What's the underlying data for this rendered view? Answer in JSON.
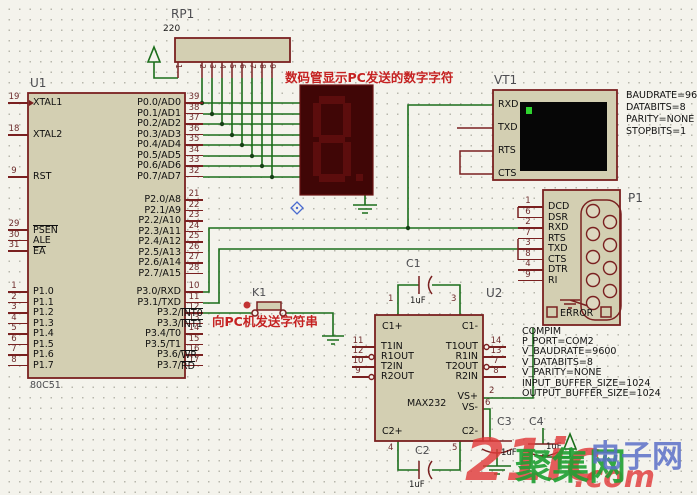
{
  "annotations": {
    "display_note": "数码管显示PC发送的数字字符",
    "send_note": "向PC机发送字符串"
  },
  "watermark": {
    "big": "21ic",
    "dot_com": ".com",
    "green": "聚集网",
    "blue": "电子网"
  },
  "u1": {
    "ref": "U1",
    "part": "80C51",
    "g_xtal1": [
      {
        "n": "19",
        "t": "XTAL1"
      }
    ],
    "g_xtal2": [
      {
        "n": "18",
        "t": "XTAL2"
      }
    ],
    "g_rst": [
      {
        "n": "9",
        "t": "RST"
      }
    ],
    "g_ctrl": [
      {
        "n": "29",
        "t": "",
        "o": "PSEN"
      },
      {
        "n": "30",
        "t": "ALE"
      },
      {
        "n": "31",
        "t": "",
        "o": "EA"
      }
    ],
    "g_p1": [
      {
        "n": "1",
        "t": "P1.0"
      },
      {
        "n": "2",
        "t": "P1.1"
      },
      {
        "n": "3",
        "t": "P1.2"
      },
      {
        "n": "4",
        "t": "P1.3"
      },
      {
        "n": "5",
        "t": "P1.4"
      },
      {
        "n": "6",
        "t": "P1.5"
      },
      {
        "n": "7",
        "t": "P1.6"
      },
      {
        "n": "8",
        "t": "P1.7"
      }
    ],
    "g_p0": [
      {
        "n": "39",
        "t": "P0.0/AD0"
      },
      {
        "n": "38",
        "t": "P0.1/AD1"
      },
      {
        "n": "37",
        "t": "P0.2/AD2"
      },
      {
        "n": "36",
        "t": "P0.3/AD3"
      },
      {
        "n": "35",
        "t": "P0.4/AD4"
      },
      {
        "n": "34",
        "t": "P0.5/AD5"
      },
      {
        "n": "33",
        "t": "P0.6/AD6"
      },
      {
        "n": "32",
        "t": "P0.7/AD7"
      }
    ],
    "g_p2": [
      {
        "n": "21",
        "t": "P2.0/A8"
      },
      {
        "n": "22",
        "t": "P2.1/A9"
      },
      {
        "n": "23",
        "t": "P2.2/A10"
      },
      {
        "n": "24",
        "t": "P2.3/A11"
      },
      {
        "n": "25",
        "t": "P2.4/A12"
      },
      {
        "n": "26",
        "t": "P2.5/A13"
      },
      {
        "n": "27",
        "t": "P2.6/A14"
      },
      {
        "n": "28",
        "t": "P2.7/A15"
      }
    ],
    "g_p3": [
      {
        "n": "10",
        "t": "P3.0/RXD"
      },
      {
        "n": "11",
        "t": "P3.1/TXD"
      },
      {
        "n": "12",
        "t": "P3.2/",
        "o": "INT0"
      },
      {
        "n": "13",
        "t": "P3.3/",
        "o": "INT1"
      },
      {
        "n": "14",
        "t": "P3.4/T0"
      },
      {
        "n": "15",
        "t": "P3.5/T1"
      },
      {
        "n": "16",
        "t": "P3.6/",
        "o": "WR"
      },
      {
        "n": "17",
        "t": "P3.7/",
        "o": "RD"
      }
    ]
  },
  "rp1": {
    "ref": "RP1",
    "value": "220",
    "pins": [
      "1",
      "2",
      "3",
      "4",
      "5",
      "6",
      "7",
      "8",
      "9"
    ]
  },
  "vt1": {
    "ref": "VT1",
    "pins": [
      "RXD",
      "TXD",
      "RTS",
      "CTS"
    ],
    "settings": [
      "BAUDRATE=9600",
      "DATABITS=8",
      "PARITY=NONE",
      "STOPBITS=1"
    ]
  },
  "p1": {
    "ref": "P1",
    "error_label": "ERROR",
    "pins": [
      {
        "n": "1",
        "t": "DCD"
      },
      {
        "n": "6",
        "t": "DSR"
      },
      {
        "n": "2",
        "t": "RXD"
      },
      {
        "n": "7",
        "t": "RTS"
      },
      {
        "n": "3",
        "t": "TXD"
      },
      {
        "n": "8",
        "t": "CTS"
      },
      {
        "n": "4",
        "t": "DTR"
      },
      {
        "n": "9",
        "t": "RI"
      }
    ],
    "settings": [
      "COMPIM",
      "P_PORT=COM2",
      "V_BAUDRATE=9600",
      "V_DATABITS=8",
      "V_PARITY=NONE",
      "INPUT_BUFFER_SIZE=1024",
      "OUTPUT_BUFFER_SIZE=1024"
    ]
  },
  "u2": {
    "ref": "U2",
    "part": "MAX232",
    "top_pins": [
      {
        "n": "1",
        "t": "C1+"
      },
      {
        "n": "3",
        "t": "C1-"
      }
    ],
    "bottom_pins": [
      {
        "n": "4",
        "t": "C2+"
      },
      {
        "n": "5",
        "t": "C2-"
      }
    ],
    "left_pins": [
      {
        "n": "11",
        "t": "T1IN"
      },
      {
        "n": "12",
        "t": "R1OUT",
        "c": true
      },
      {
        "n": "10",
        "t": "T2IN"
      },
      {
        "n": "9",
        "t": "R2OUT",
        "c": true
      }
    ],
    "right_pins": [
      {
        "n": "14",
        "t": "T1OUT",
        "c": true
      },
      {
        "n": "13",
        "t": "R1IN"
      },
      {
        "n": "7",
        "t": "T2OUT",
        "c": true
      },
      {
        "n": "8",
        "t": "R2IN"
      }
    ],
    "vs_pins": [
      {
        "n": "2",
        "t": "VS+"
      },
      {
        "n": "6",
        "t": "VS-"
      }
    ]
  },
  "k1": {
    "ref": "K1"
  },
  "caps": {
    "c1": {
      "ref": "C1",
      "value": "1uF"
    },
    "c2": {
      "ref": "C2",
      "value": "1uF"
    },
    "c3": {
      "ref": "C3",
      "value": "1uF"
    },
    "c4": {
      "ref": "C4",
      "value": "1uF"
    }
  },
  "colors": {
    "wire": "#1b6e1b",
    "component": "#7a2020",
    "body": "#d3cfb2",
    "note": "#c52222",
    "screen_cursor": "#2fd32f"
  }
}
